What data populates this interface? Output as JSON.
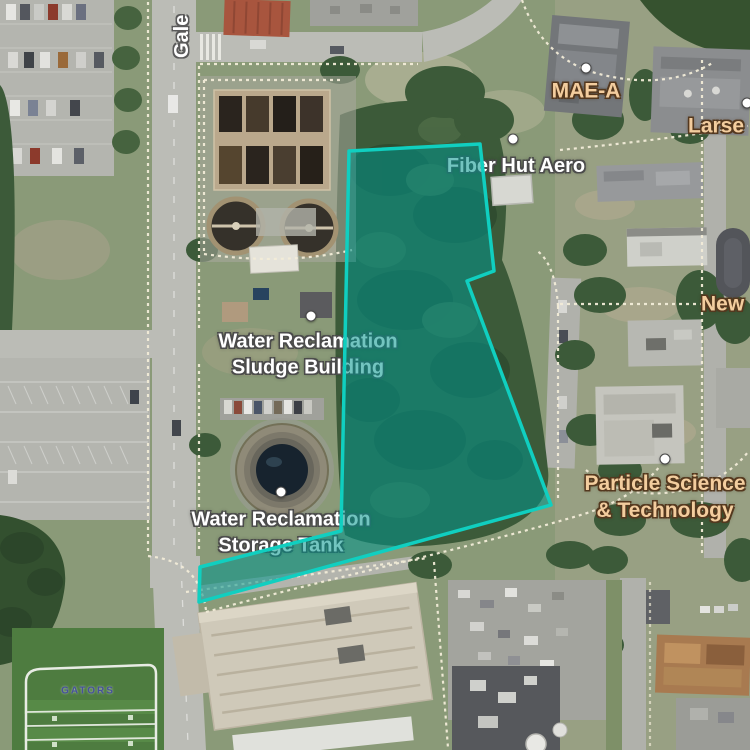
{
  "labels": {
    "gale": "Gale",
    "fiber_hut_aero": "Fiber Hut Aero",
    "mae_a": "MAE-A",
    "larsen_partial": "Larse",
    "newell_partial": "New",
    "sludge_building_line1": "Water Reclamation",
    "sludge_building_line2": "Sludge Building",
    "storage_tank_line1": "Water Reclamation",
    "storage_tank_line2": "Storage Tank",
    "particle_line1": "Particle Science",
    "particle_line2": "& Technology",
    "gators_field": "GATORS"
  },
  "selection": {
    "points": "349,151 480,144 494,271 467,281 551,505 199,602 200,567 341,531",
    "stroke_color": "#10cfc0",
    "fill_color": "rgba(0,150,140,0.55)"
  },
  "colors": {
    "poi_label": "#ffffff",
    "building_label": "#f3cd9e",
    "selection_teal": "#10cfc0"
  }
}
